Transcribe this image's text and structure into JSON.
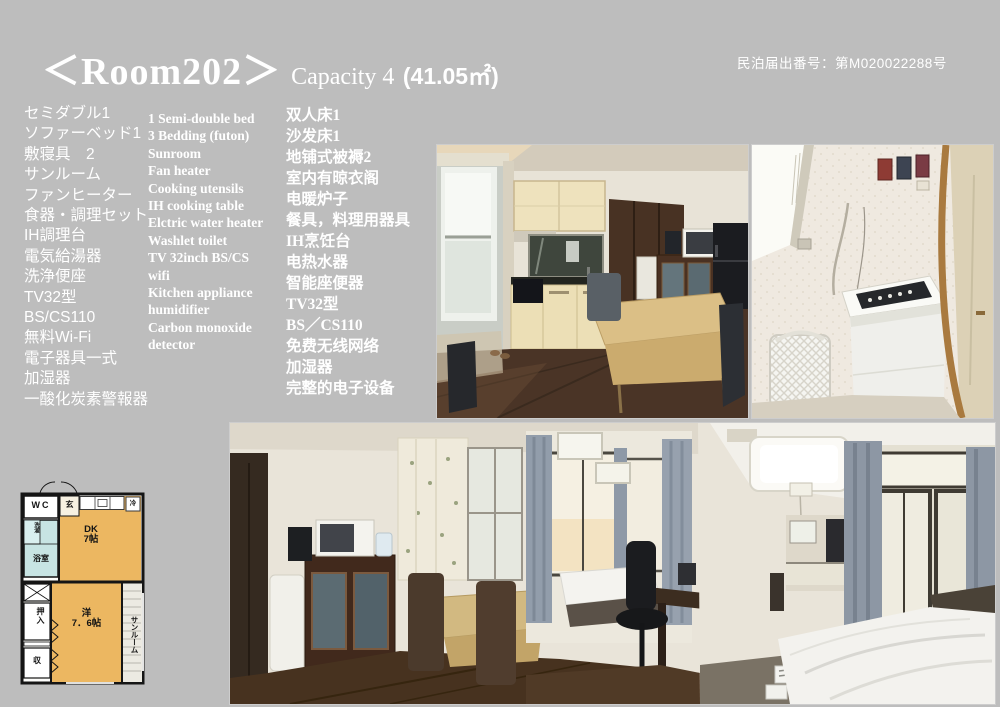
{
  "page": {
    "background_color": "#bdbdbd",
    "text_color": "#ffffff"
  },
  "header": {
    "room_title": "＜Room202＞",
    "capacity_label": "Capacity 4",
    "area_label": "(41.05㎡)",
    "registration": "民泊届出番号：第M020022288号"
  },
  "amenities": {
    "japanese": [
      "セミダブル1",
      "ソファーベッド1",
      "敷寝具　2",
      "サンルーム",
      "ファンヒーター",
      "食器・調理セット",
      "IH調理台",
      "電気給湯器",
      "洗浄便座",
      "TV32型",
      "BS/CS110",
      "無料Wi-Fi",
      "電子器具一式",
      "加湿器",
      "一酸化炭素警報器"
    ],
    "english": [
      "1 Semi-double bed",
      "3 Bedding (futon)",
      "Sunroom",
      "Fan heater",
      "Cooking utensils",
      "IH cooking table",
      "Elctric water heater",
      "Washlet toilet",
      "TV 32inch BS/CS",
      "wifi",
      "Kitchen appliance",
      "humidifier",
      "Carbon monoxide",
      "detector"
    ],
    "chinese": [
      "双人床1",
      "沙发床1",
      "地铺式被褥2",
      "室内有晾衣阁",
      "电暖炉子",
      "餐具，料理用器具",
      "IH烹饪台",
      "电热水器",
      "智能座便器",
      "TV32型",
      "BS／CS110",
      "免费无线网络",
      "加湿器",
      "完整的电子设备"
    ]
  },
  "floorplan": {
    "wc": "WC",
    "entrance": "玄",
    "laundry": "洗濯",
    "bath": "浴室",
    "fridge": "冷",
    "dk_line1": "DK",
    "dk_line2": "7帖",
    "closet": "押入",
    "storage": "収",
    "western_line1": "洋",
    "western_line2": "7．6帖",
    "sunroom": "サンルーム",
    "colors": {
      "room": "#ecb761",
      "bath": "#c7e4e3",
      "wall": "#151515"
    }
  }
}
